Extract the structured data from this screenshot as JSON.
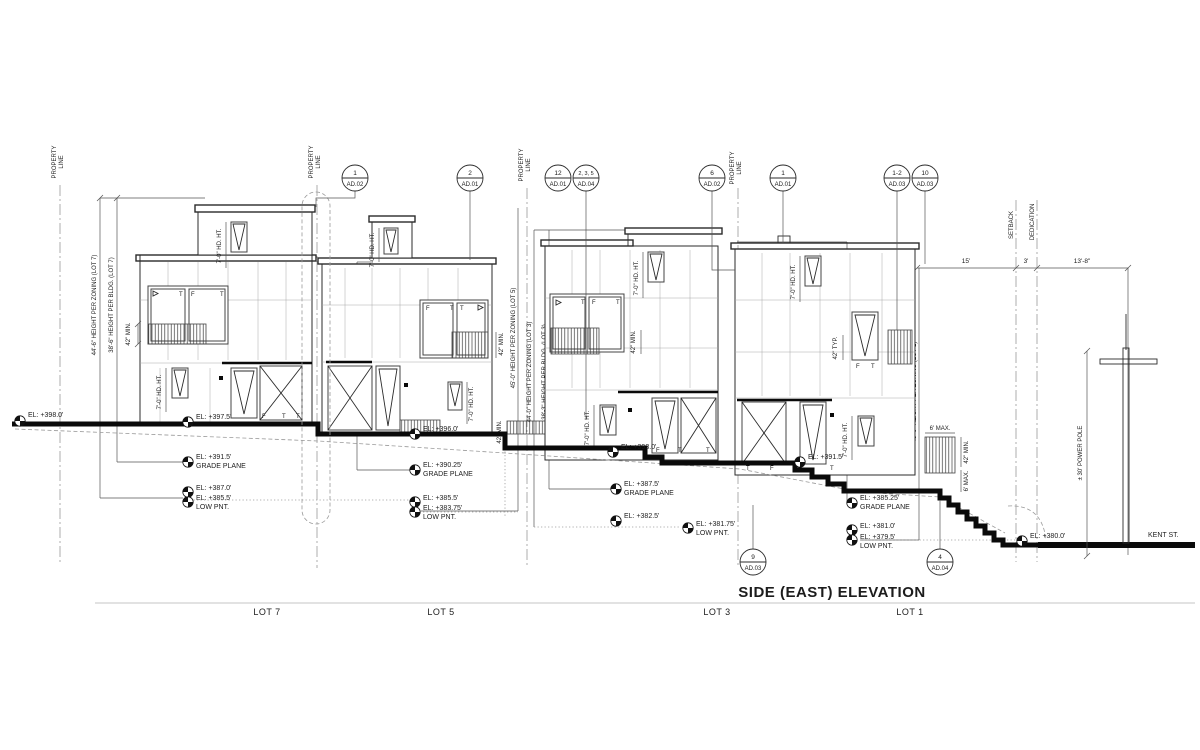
{
  "title": "SIDE (EAST) ELEVATION",
  "street_label": "KENT ST.",
  "property_line_1": "PROPERTY",
  "property_line_2": "LINE",
  "setback": "SETBACK",
  "dedication": "DEDICATION",
  "power_pole": "± 30' POWER POLE",
  "top_dims": {
    "setback_width": "15'",
    "dedication_width": "3'",
    "street_width": "13'-8\""
  },
  "ann": {
    "hd_ht": "7'-0\" HD. HT.",
    "min42": "42\" MIN.",
    "typ42": "42\" TYP.",
    "max6": "6' MAX."
  },
  "glass": {
    "t": "T",
    "f": "F"
  },
  "lots": [
    {
      "label": "LOT 7",
      "zoning": "44'-6\" HEIGHT PER ZONING (LOT 7)",
      "bldg": "38'-6\" HEIGHT PER BLDG. (LOT 7)",
      "el_street": "EL: +398.0'",
      "el_pad": "EL: +397.5'",
      "el_grade": "EL: +391.5'",
      "grade_label": "GRADE PLANE",
      "el_mid": "EL: +387.0'",
      "el_low": "EL: +385.5'",
      "low_label": "LOW PNT."
    },
    {
      "label": "LOT 5",
      "zoning": "45'-0\" HEIGHT PER ZONING (LOT 5)",
      "bldg": "38'-9\" HEIGHT PER BLDG. (LOT 5)",
      "el_pad": "EL: +396.0'",
      "el_grade": "EL: +390.25'",
      "grade_label": "GRADE PLANE",
      "el_mid": "EL: +385.5'",
      "el_low": "EL: +383.75'",
      "low_label": "LOW PNT."
    },
    {
      "label": "LOT 3",
      "zoning": "44'-0\" HEIGHT PER ZONING (LOT 3)",
      "bldg": "38'-3\" HEIGHT PER BLDG. (LOT 3)",
      "el_pad": "EL: +393.0'",
      "el_pad2": "EL: +391.5'",
      "el_grade": "EL: +387.5'",
      "grade_label": "GRADE PLANE",
      "el_mid": "EL: +382.5'",
      "el_low": "EL: +381.75'",
      "low_label": "LOW PNT."
    },
    {
      "label": "LOT 1",
      "zoning": "45'-0\" HEIGHT PER ZONING (LOT 1)",
      "bldg": "39'-3\" HEIGHT PER BLDG. (LOT 1)",
      "el_grade": "EL: +385.25'",
      "grade_label": "GRADE PLANE",
      "el_mid": "EL: +381.0'",
      "el_low": "EL: +379.5'",
      "low_label": "LOW PNT.",
      "el_street": "EL: +380.0'"
    }
  ],
  "bubbles": [
    {
      "num": "1",
      "sheet": "AD.02"
    },
    {
      "num": "2",
      "sheet": "AD.01"
    },
    {
      "num": "12",
      "sheet": "AD.01"
    },
    {
      "num": "2, 3, 5",
      "sheet": "AD.04"
    },
    {
      "num": "6",
      "sheet": "AD.02"
    },
    {
      "num": "1",
      "sheet": "AD.01"
    },
    {
      "num": "1-2",
      "sheet": "AD.03"
    },
    {
      "num": "10",
      "sheet": "AD.03"
    },
    {
      "num": "9",
      "sheet": "AD.03"
    },
    {
      "num": "4",
      "sheet": "AD.04"
    }
  ]
}
